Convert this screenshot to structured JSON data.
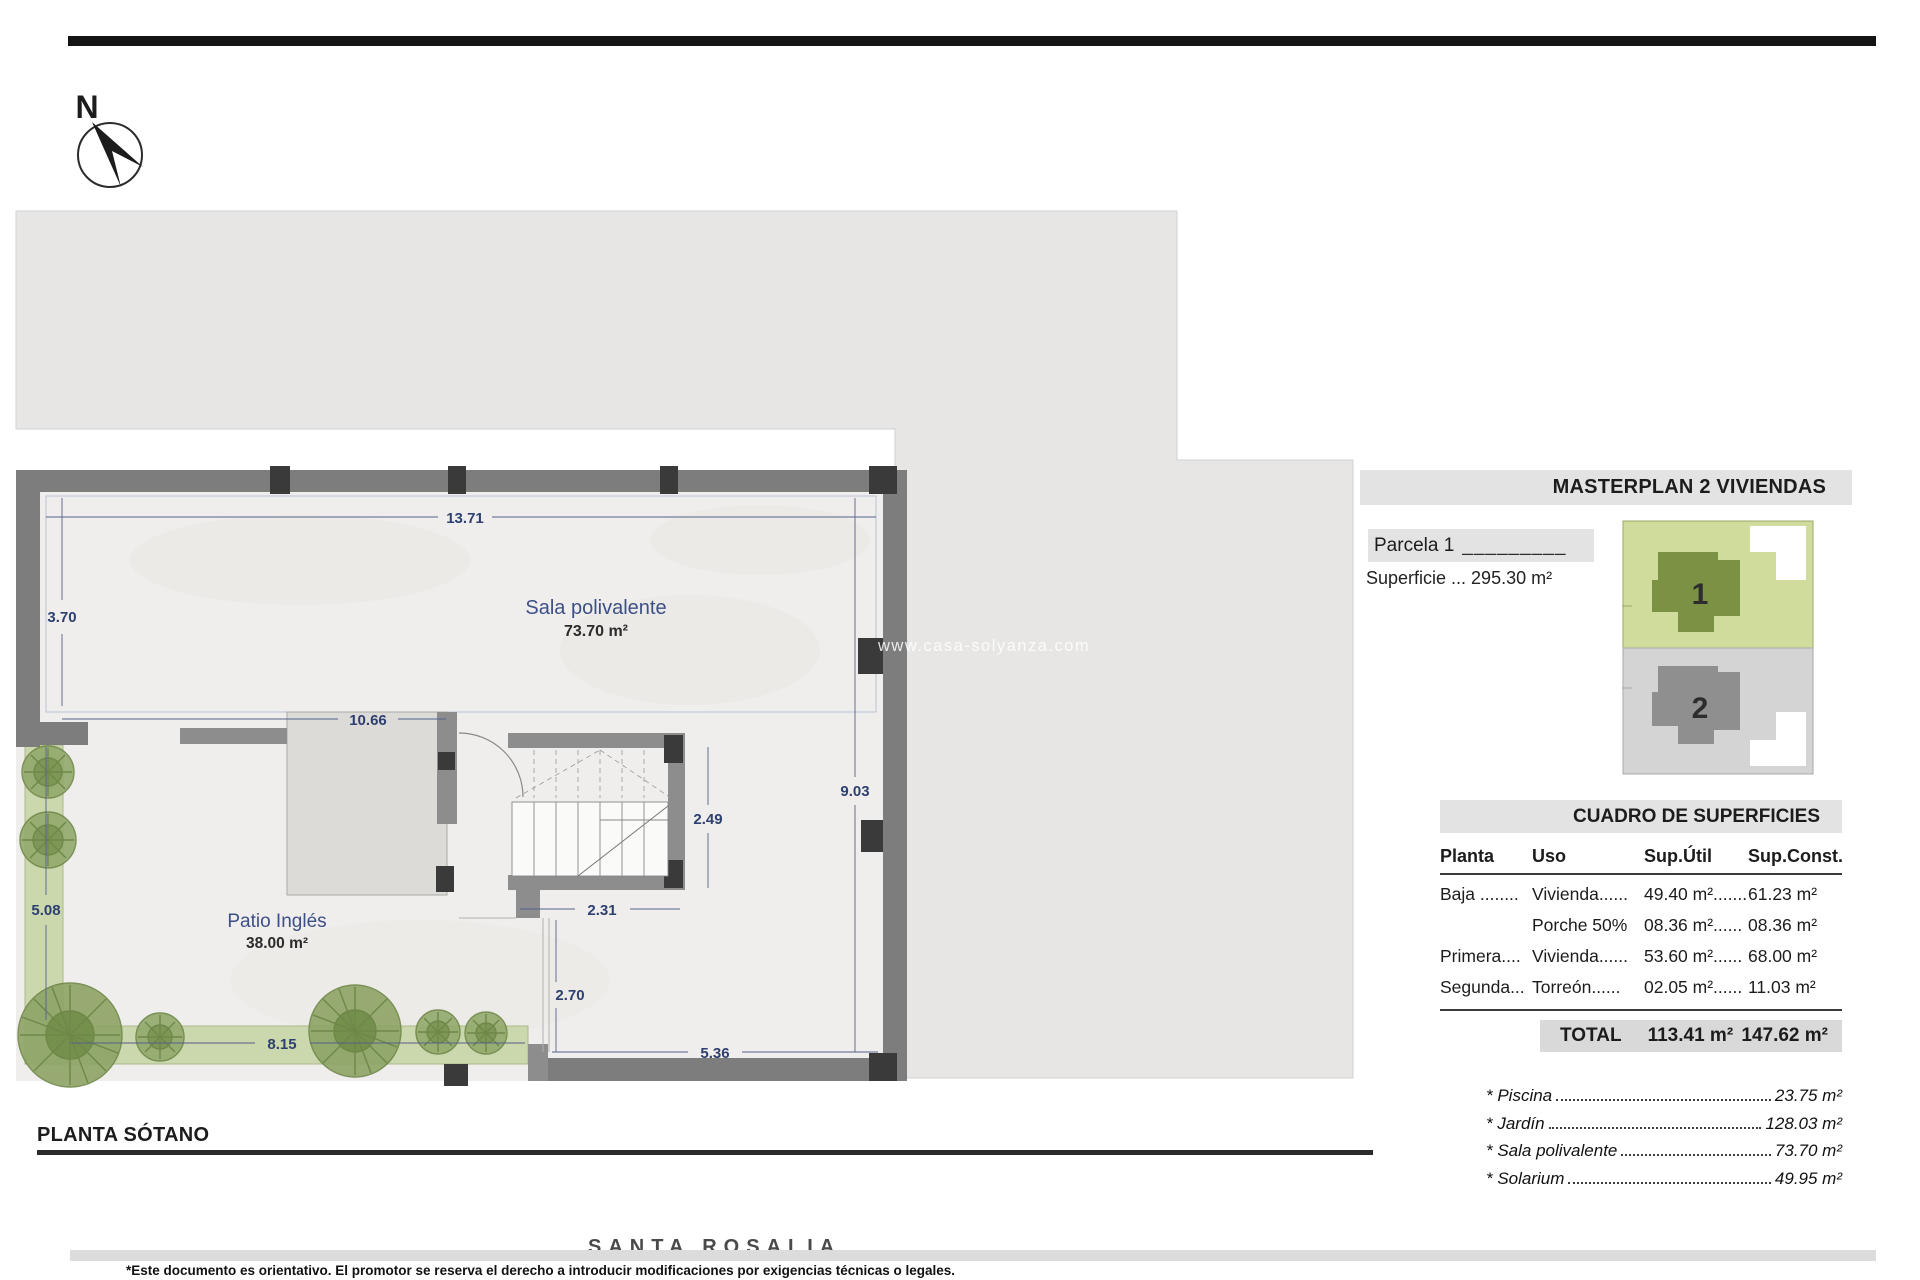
{
  "north_label": "N",
  "watermark": "www.casa-solyanza.com",
  "plan": {
    "title": "PLANTA SÓTANO",
    "rooms": {
      "sala": {
        "name": "Sala polivalente",
        "area": "73.70 m²"
      },
      "patio": {
        "name": "Patio Inglés",
        "area": "38.00 m²"
      }
    },
    "dims": {
      "top": "13.71",
      "left_upper": "3.70",
      "hall": "10.66",
      "right": "9.03",
      "stair_height": "2.49",
      "stair_width": "2.31",
      "garden_left": "5.08",
      "passage": "2.70",
      "garden_bottom": "8.15",
      "bottom_right": "5.36"
    }
  },
  "masterplan": {
    "title": "MASTERPLAN 2 VIVIENDAS",
    "parcel_label": "Parcela 1",
    "parcel_rule": "_________",
    "superficie": "Superficie ... 295.30 m²",
    "plots": [
      {
        "number": "1"
      },
      {
        "number": "2"
      }
    ]
  },
  "surfaces": {
    "title": "CUADRO DE SUPERFICIES",
    "columns": [
      "Planta",
      "Uso",
      "Sup.Útil",
      "Sup.Const."
    ],
    "rows": [
      {
        "planta": "Baja ........",
        "uso": "Vivienda......",
        "util": "49.40 m².......",
        "const": "61.23 m²"
      },
      {
        "planta": "",
        "uso": "Porche 50%",
        "util": "08.36 m²......",
        "const": "08.36 m²"
      },
      {
        "planta": "Primera....",
        "uso": "Vivienda......",
        "util": "53.60 m²......",
        "const": "68.00 m²"
      },
      {
        "planta": "Segunda...",
        "uso": "Torreón......",
        "util": "02.05 m²......",
        "const": "11.03 m²"
      }
    ],
    "total": {
      "label": "TOTAL",
      "util": "113.41 m²",
      "const": "147.62 m²"
    },
    "extras": [
      {
        "name": "* Piscina",
        "value": "23.75 m²"
      },
      {
        "name": "* Jardín",
        "value": "128.03 m²"
      },
      {
        "name": "* Sala polivalente",
        "value": "73.70 m²"
      },
      {
        "name": "* Solarium",
        "value": "49.95 m²"
      }
    ]
  },
  "project_name": "SANTA ROSALIA",
  "footer": "*Este documento es orientativo. El promotor se reserva el derecho a introducir modificaciones por exigencias técnicas o legales.",
  "colors": {
    "site_gray": "#e7e6e5",
    "wall_gray": "#7d7d7d",
    "column_dark": "#3a3a3a",
    "floor": "#efeeec",
    "garden_green": "#cbd7ad",
    "dim_blue": "#2e4070",
    "parcel_green_light": "#cfdc9b",
    "parcel_green_dark": "#7b9143",
    "parcel_gray_light": "#d4d4d4",
    "parcel_gray_dark": "#8f8f8f"
  }
}
